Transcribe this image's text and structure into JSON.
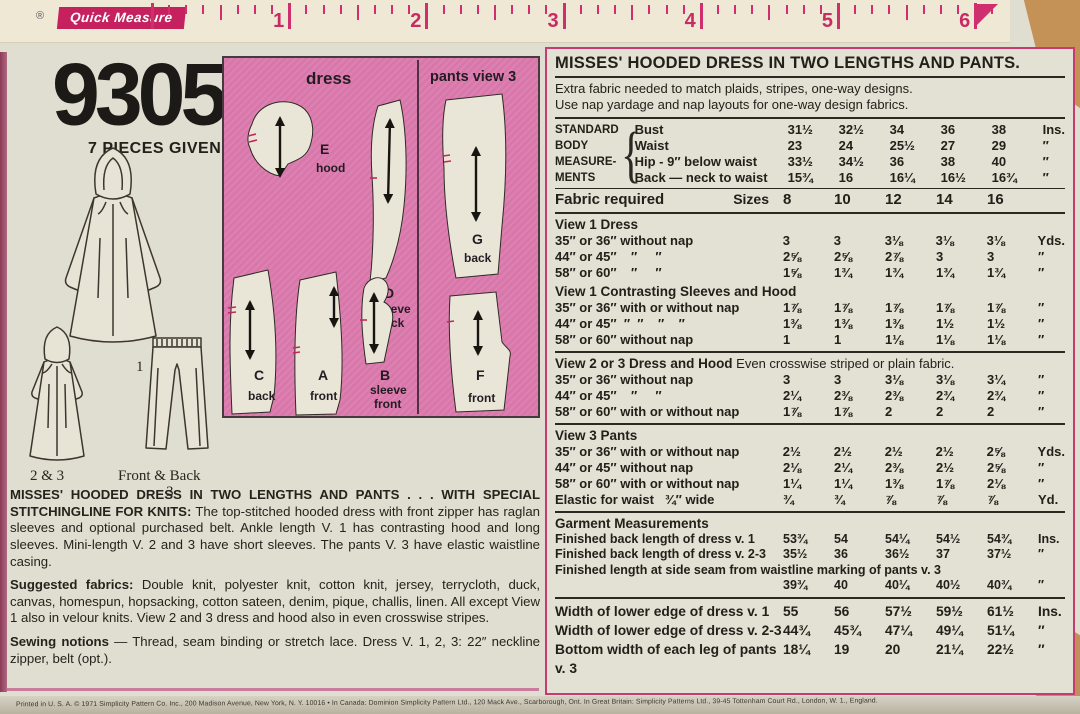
{
  "ruler": {
    "reg_mark": "®",
    "brand": "Quick Measure",
    "numbers": [
      "1",
      "2",
      "3",
      "4",
      "5",
      "6"
    ]
  },
  "left": {
    "pattern_number": "9305",
    "pieces_given": "7 PIECES GIVEN",
    "view_labels": {
      "view1": "1",
      "view23": "2 & 3",
      "pants_caption": "Front & Back",
      "pants_number": "3"
    },
    "pink_box": {
      "header_left": "dress",
      "header_right": "pants view 3",
      "pieces": [
        {
          "letter": "E",
          "name_lines": [
            "hood"
          ]
        },
        {
          "letter": "D",
          "name_lines": [
            "sleeve",
            "back"
          ]
        },
        {
          "letter": "G",
          "name_lines": [
            "back"
          ]
        },
        {
          "letter": "C",
          "name_lines": [
            "back"
          ]
        },
        {
          "letter": "A",
          "name_lines": [
            "front"
          ]
        },
        {
          "letter": "B",
          "name_lines": [
            "sleeve",
            "front"
          ]
        },
        {
          "letter": "F",
          "name_lines": [
            "front"
          ]
        }
      ]
    },
    "paragraphs": [
      {
        "lead": "MISSES' HOODED DRESS IN TWO LENGTHS AND PANTS . . . WITH SPECIAL STITCHINGLINE FOR KNITS:",
        "text": " The top-stitched hooded dress with front zipper has raglan sleeves and optional purchased belt. Ankle length V. 1 has contrasting hood and long sleeves. Mini-length V. 2 and 3 have short sleeves. The pants V. 3 have elastic waistline casing."
      },
      {
        "lead": "Suggested fabrics:",
        "text": " Double knit, polyester knit, cotton knit, jersey, terrycloth, duck, canvas, homespun, hopsacking, cotton sateen, denim, pique, challis, linen. All except View 1 also in velour knits. View 2 and 3 dress and hood also in even crosswise stripes."
      },
      {
        "lead": "Sewing notions",
        "text": " — Thread, seam binding or stretch lace. Dress V. 1, 2, 3: 22″ neckline zipper, belt (opt.)."
      }
    ],
    "fine_print": "Printed in U. S. A.   © 1971 Simplicity Pattern Co. Inc., 200 Madison Avenue, New York, N. Y. 10016      •      In Canada:   Dominion Simplicity Pattern Ltd., 120 Mack Ave., Scarborough, Ont.        In Great Britain:   Simplicity Patterns Ltd., 39-45 Tottenham Court Rd., London, W. 1., England."
  },
  "right": {
    "title": "MISSES' HOODED DRESS IN TWO LENGTHS AND PANTS.",
    "intro_lines": [
      "Extra fabric needed to match plaids, stripes, one-way designs.",
      "Use nap yardage and nap layouts for one-way design fabrics."
    ],
    "measurements": {
      "header_lines": [
        "STANDARD",
        "BODY",
        "MEASURE-",
        "MENTS"
      ],
      "brace": "{",
      "rows": [
        {
          "label": "Bust",
          "values": [
            "31½",
            "32½",
            "34",
            "36",
            "38"
          ],
          "unit": "Ins."
        },
        {
          "label": "Waist",
          "values": [
            "23",
            "24",
            "25½",
            "27",
            "29"
          ],
          "unit": "″"
        },
        {
          "label": "Hip - 9″ below waist",
          "values": [
            "33½",
            "34½",
            "36",
            "38",
            "40"
          ],
          "unit": "″"
        },
        {
          "label": "Back — neck to waist",
          "values": [
            "15¾",
            "16",
            "16¼",
            "16½",
            "16¾"
          ],
          "unit": "″"
        }
      ]
    },
    "fabric_required": {
      "label": "Fabric required",
      "sizes_label": "Sizes",
      "sizes": [
        "8",
        "10",
        "12",
        "14",
        "16"
      ]
    },
    "sections": [
      {
        "title": "View 1   Dress",
        "note": "",
        "rows": [
          {
            "label": "35″ or 36″ without nap",
            "values": [
              "3",
              "3",
              "3⅛",
              "3⅛",
              "3⅛"
            ],
            "unit": "Yds."
          },
          {
            "label": "44″ or 45″    ″     ″",
            "values": [
              "2⅝",
              "2⅝",
              "2⅞",
              "3",
              "3"
            ],
            "unit": "″"
          },
          {
            "label": "58″ or 60″    ″     ″",
            "values": [
              "1⅝",
              "1¾",
              "1¾",
              "1¾",
              "1¾"
            ],
            "unit": "″"
          }
        ]
      },
      {
        "title": "View 1   Contrasting Sleeves and Hood",
        "note": "",
        "rows": [
          {
            "label": "35″ or 36″ with or without nap",
            "values": [
              "1⅞",
              "1⅞",
              "1⅞",
              "1⅞",
              "1⅞"
            ],
            "unit": "″"
          },
          {
            "label": "44″ or 45″  ″  ″    ″    ″",
            "values": [
              "1⅜",
              "1⅜",
              "1⅜",
              "1½",
              "1½"
            ],
            "unit": "″"
          },
          {
            "label": "58″ or 60″ without nap",
            "values": [
              "1",
              "1",
              "1⅛",
              "1⅛",
              "1⅛"
            ],
            "unit": "″"
          }
        ]
      },
      {
        "title": "View 2 or 3   Dress and Hood",
        "note": "  Even crosswise striped or plain fabric.",
        "rows": [
          {
            "label": "35″ or 36″ without nap",
            "values": [
              "3",
              "3",
              "3⅛",
              "3⅛",
              "3¼"
            ],
            "unit": "″"
          },
          {
            "label": "44″ or 45″    ″     ″",
            "values": [
              "2¼",
              "2⅜",
              "2⅜",
              "2¾",
              "2¾"
            ],
            "unit": "″"
          },
          {
            "label": "58″ or 60″ with or without nap",
            "values": [
              "1⅞",
              "1⅞",
              "2",
              "2",
              "2"
            ],
            "unit": "″"
          }
        ]
      },
      {
        "title": "View 3   Pants",
        "note": "",
        "rows": [
          {
            "label": "35″ or 36″ with or without nap",
            "values": [
              "2½",
              "2½",
              "2½",
              "2½",
              "2⅝"
            ],
            "unit": "Yds."
          },
          {
            "label": "44″ or 45″ without nap",
            "values": [
              "2⅛",
              "2¼",
              "2⅜",
              "2½",
              "2⅝"
            ],
            "unit": "″"
          },
          {
            "label": "58″ or 60″ with or without nap",
            "values": [
              "1¼",
              "1¼",
              "1⅜",
              "1⅞",
              "2⅛"
            ],
            "unit": "″"
          },
          {
            "label": "Elastic for waist   ¾″ wide",
            "values": [
              "¾",
              "¾",
              "⅞",
              "⅞",
              "⅞"
            ],
            "unit": "Yd."
          }
        ]
      },
      {
        "title": "Garment Measurements",
        "note": "",
        "small": true,
        "rows": [
          {
            "label": "Finished back length of dress v. 1",
            "values": [
              "53¾",
              "54",
              "54¼",
              "54½",
              "54¾"
            ],
            "unit": "Ins."
          },
          {
            "label": "Finished back length of dress v. 2-3",
            "values": [
              "35½",
              "36",
              "36½",
              "37",
              "37½"
            ],
            "unit": "″"
          },
          {
            "label": "Finished length at side seam from waistline marking of pants v. 3",
            "label_only": true
          },
          {
            "label": "",
            "values": [
              "39¾",
              "40",
              "40¼",
              "40½",
              "40¾"
            ],
            "unit": "″"
          }
        ]
      }
    ],
    "width_rows": [
      {
        "label": "Width of lower edge of dress v. 1",
        "values": [
          "55",
          "56",
          "57½",
          "59½",
          "61½"
        ],
        "unit": "Ins."
      },
      {
        "label": "Width of lower edge of dress v. 2-3",
        "values": [
          "44¾",
          "45¾",
          "47¼",
          "49¼",
          "51¼"
        ],
        "unit": "″"
      },
      {
        "label": "Bottom width of each leg of pants v. 3",
        "values": [
          "18¼",
          "19",
          "20",
          "21¼",
          "22½"
        ],
        "unit": "″"
      }
    ]
  }
}
